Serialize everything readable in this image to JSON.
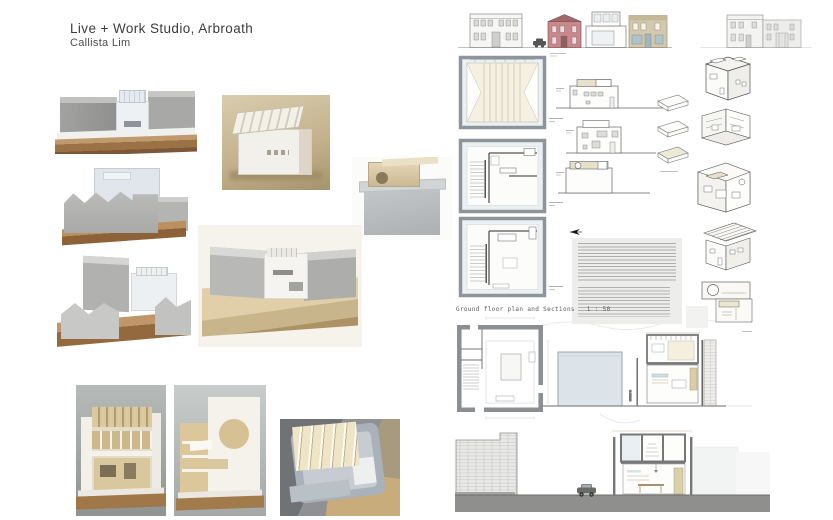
{
  "header": {
    "title": "Live + Work Studio, Arbroath",
    "author": "Callista Lim"
  },
  "drawings": {
    "ground_floor_caption": "Ground floor plan and Sections   1 : 50"
  },
  "palette": {
    "page_bg": "#ffffff",
    "plan_fill_blue": "#eaf1f5",
    "plan_wall_grey": "#8e9499",
    "cardboard_base": "#a87c4e",
    "model_grey": "#aeaeac",
    "roof_beige": "#e7e0cb",
    "sandstone_pink": "#c9898b",
    "sand_tan": "#d3c9ae",
    "section_block_blue": "#dce4e9",
    "ground_band_grey": "#8f8f8d"
  }
}
